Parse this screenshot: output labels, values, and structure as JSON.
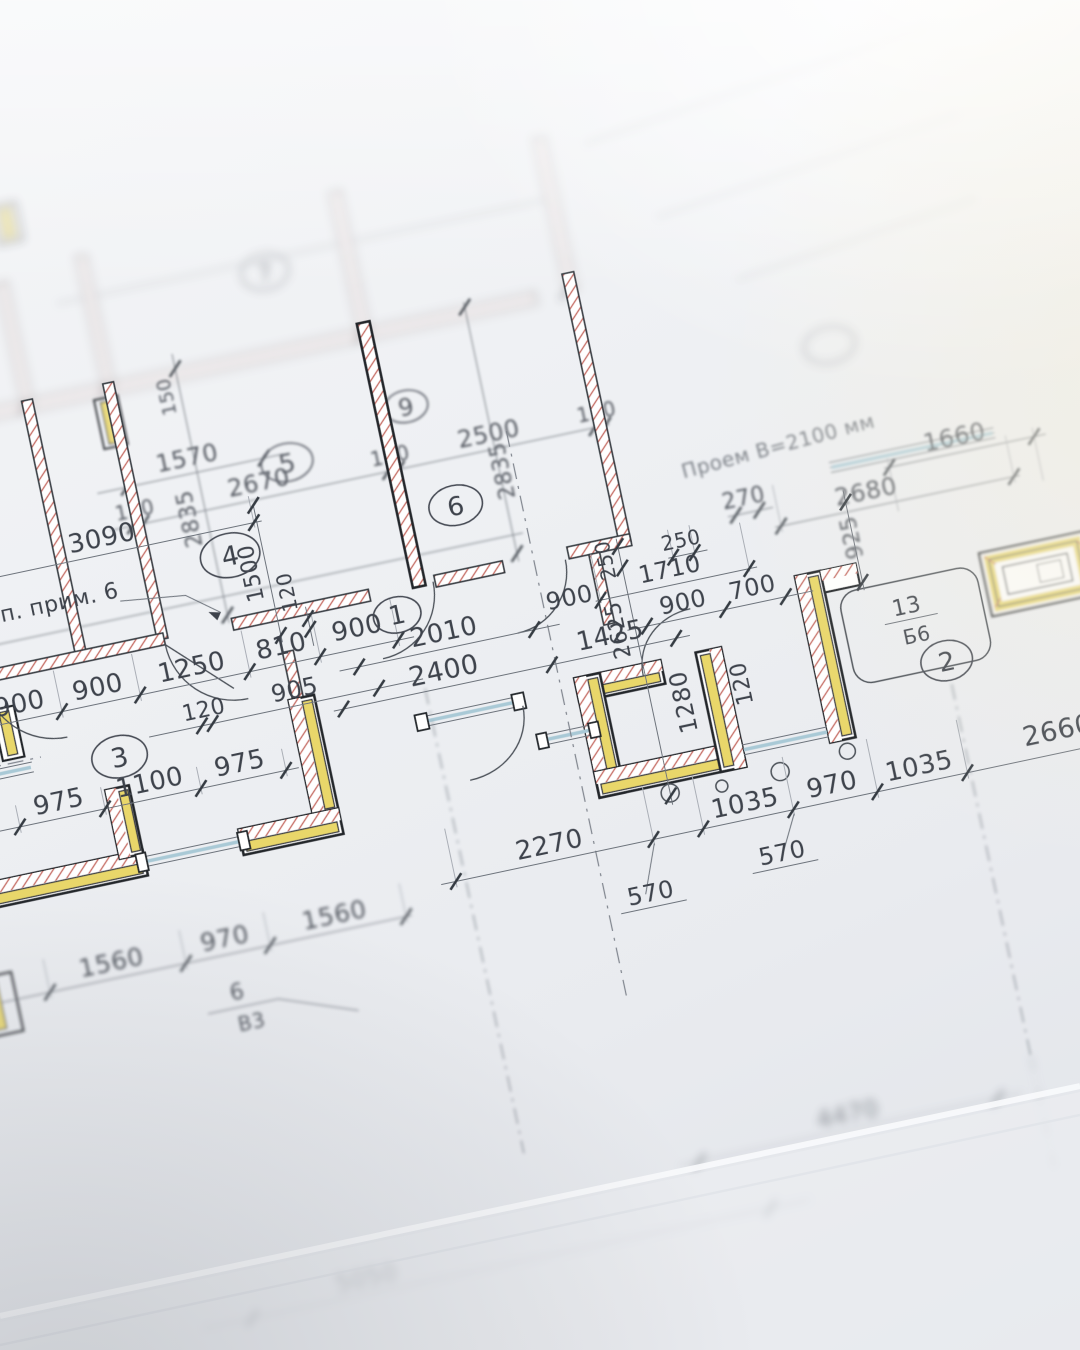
{
  "dims": {
    "d1570": "1570",
    "d3090": "3090",
    "d120_a": "120",
    "d2670": "2670",
    "d120_b": "120",
    "d2500": "2500",
    "d120_c": "120",
    "d150": "150",
    "d2835_a": "2835",
    "d2835_b": "2835",
    "d1500": "1500",
    "d120_v": "120",
    "d900_a": "900",
    "d900_b": "900",
    "d1250": "1250",
    "d810": "810",
    "d900_c": "900",
    "d120_d": "120",
    "d905": "905",
    "d2010": "2010",
    "d2400": "2400",
    "d1425": "1425",
    "d900_d": "900",
    "d900_e": "900",
    "d700": "700",
    "d250_a": "250",
    "d2625": "2625",
    "d1710": "1710",
    "d250_b": "250",
    "d925": "925",
    "d270": "270",
    "d2680": "2680",
    "d1660": "1660",
    "d1280": "1280",
    "d120_e": "120",
    "d975_a": "975",
    "d1100": "1100",
    "d975_b": "975",
    "d2270": "2270",
    "d570_a": "570",
    "d570_b": "570",
    "d1035_a": "1035",
    "d970_a": "970",
    "d1035_b": "1035",
    "d2660": "2660",
    "d1560_a": "1560",
    "d970_b": "970",
    "d1560_b": "1560",
    "d4470": "4470",
    "d5050": "5050"
  },
  "rooms": {
    "r1": "1",
    "r2": "2",
    "r3": "3",
    "r4": "4",
    "r5": "5",
    "r6": "6",
    "r7": "7",
    "r9": "9"
  },
  "marks": {
    "door_top": "13",
    "door_bottom": "Б6",
    "win_top": "6",
    "win_bottom": "В3"
  },
  "notes": {
    "prim": "п. прим. 6",
    "opening": "Проем В=2100 мм"
  },
  "colors": {
    "paper": "#eef0f3",
    "wall_yellow": "#e9d76a",
    "hatch_red": "#c4655c",
    "wall_outline": "#24272c",
    "window_blue": "#a9c9d6",
    "dim_line": "#6d737c",
    "text": "#3e434c",
    "dash_axis": "#80858e",
    "bright_wash": "#ffffff"
  }
}
